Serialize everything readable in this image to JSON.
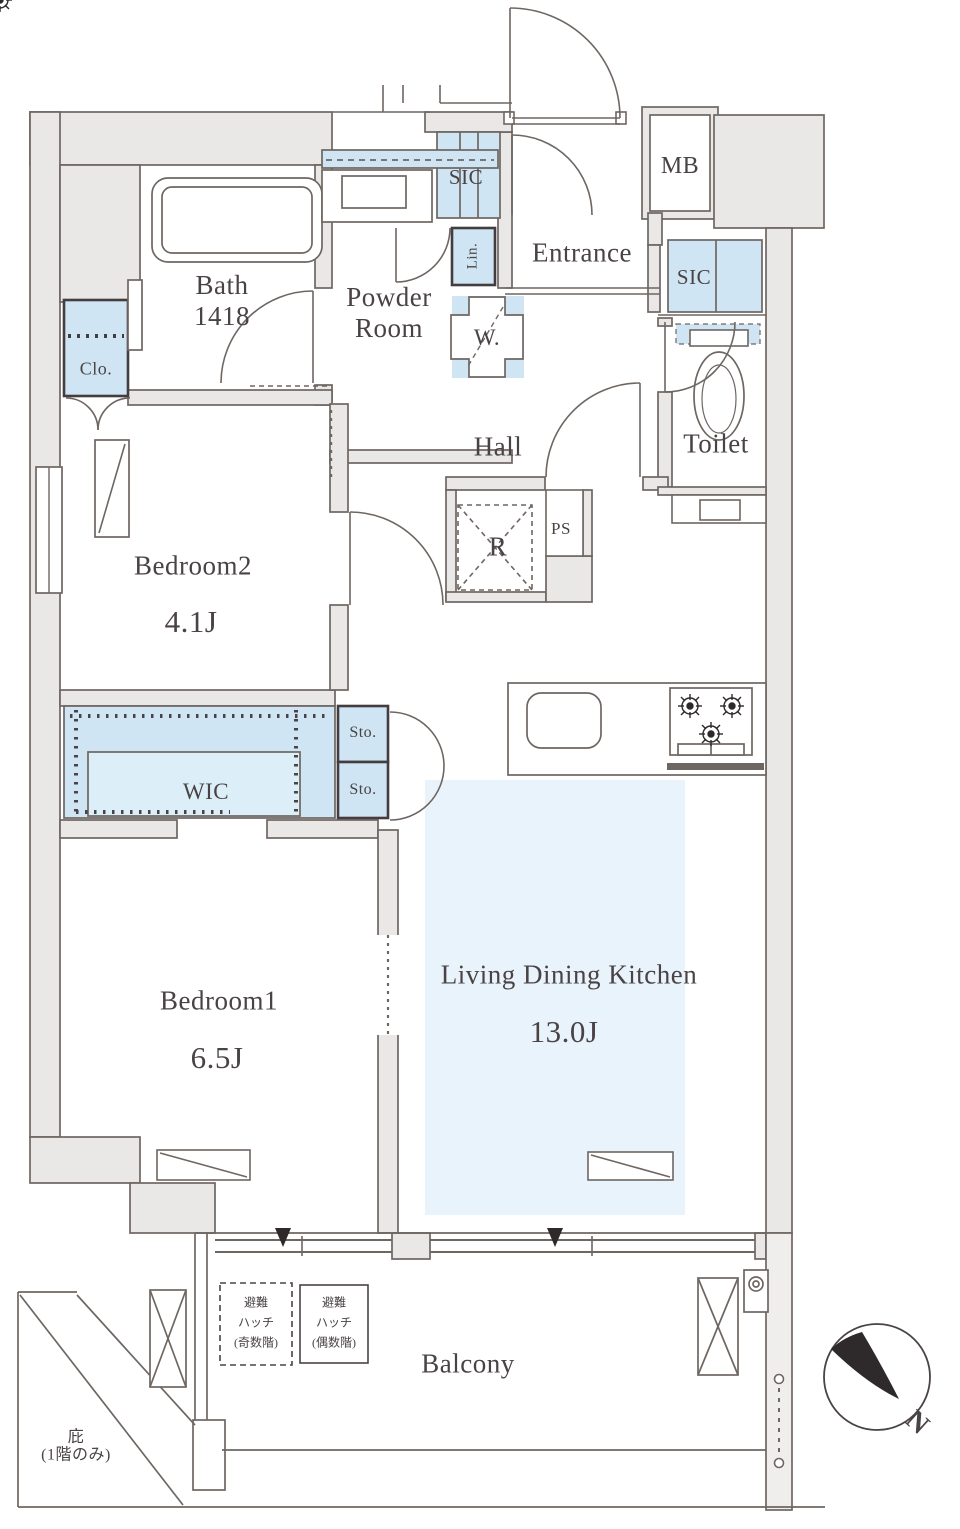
{
  "plan": {
    "rooms": {
      "bath": {
        "name": "Bath",
        "size": "1418"
      },
      "powder_room": {
        "name": "Powder Room"
      },
      "sic_hall": {
        "name": "SIC"
      },
      "linen": {
        "name": "Lin."
      },
      "washer": {
        "name": "W."
      },
      "entrance": {
        "name": "Entrance"
      },
      "meter_box": {
        "name": "MB"
      },
      "sic_entrance": {
        "name": "SIC"
      },
      "toilet": {
        "name": "Toilet"
      },
      "hall": {
        "name": "Hall"
      },
      "refrigerator_space": {
        "name": "R"
      },
      "pipe_space": {
        "name": "PS"
      },
      "closet": {
        "name": "Clo."
      },
      "bedroom2": {
        "name": "Bedroom2",
        "size": "4.1J"
      },
      "wic": {
        "name": "WIC"
      },
      "storage_upper": {
        "name": "Sto."
      },
      "storage_lower": {
        "name": "Sto."
      },
      "bedroom1": {
        "name": "Bedroom1",
        "size": "6.5J"
      },
      "ldk": {
        "name": "Living Dining Kitchen",
        "size": "13.0J"
      },
      "balcony": {
        "name": "Balcony"
      }
    },
    "annotations": {
      "eaves_line1": "庇",
      "eaves_line2": "(1階のみ)",
      "hatch_odd": {
        "line1": "避難",
        "line2": "ハッチ",
        "line3": "(奇数階)"
      },
      "hatch_even": {
        "line1": "避難",
        "line2": "ハッチ",
        "line3": "(偶数階)"
      },
      "compass_north": "N"
    },
    "colors": {
      "wall_fill": "#e9e8e6",
      "line": "#6e6661",
      "storage_fill": "#cfe5f3",
      "storage_fill_light": "#dceef8",
      "ldk_fill": "#e9f3fb",
      "text": "#4a4345",
      "dark": "#2e2a2b"
    }
  }
}
